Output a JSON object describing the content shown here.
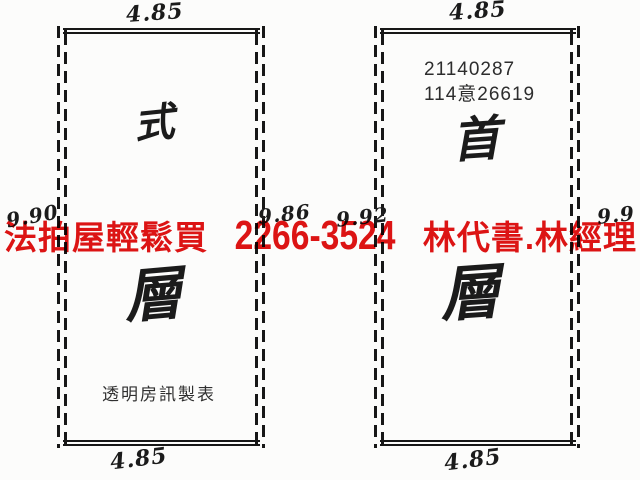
{
  "colors": {
    "paper": "#fcfcfb",
    "ink": "#171717",
    "watermark_red": "#df1414"
  },
  "watermark": {
    "left_text": "法拍屋輕鬆買",
    "phone": "2266-3524",
    "right_text": "林代書.林經理"
  },
  "left_plan": {
    "width_top": "4.85",
    "width_bottom": "4.85",
    "height_left": "9.90",
    "height_right": "9.86",
    "floor_top": "式",
    "floor_bottom": "層",
    "caption": "透明房訊製表"
  },
  "right_plan": {
    "width_top": "4.85",
    "width_bottom": "4.85",
    "height_left": "9.92",
    "height_right": "9.9",
    "case_no_line1": "21140287",
    "case_no_line2": "114意26619",
    "floor_top": "首",
    "floor_bottom": "層"
  }
}
